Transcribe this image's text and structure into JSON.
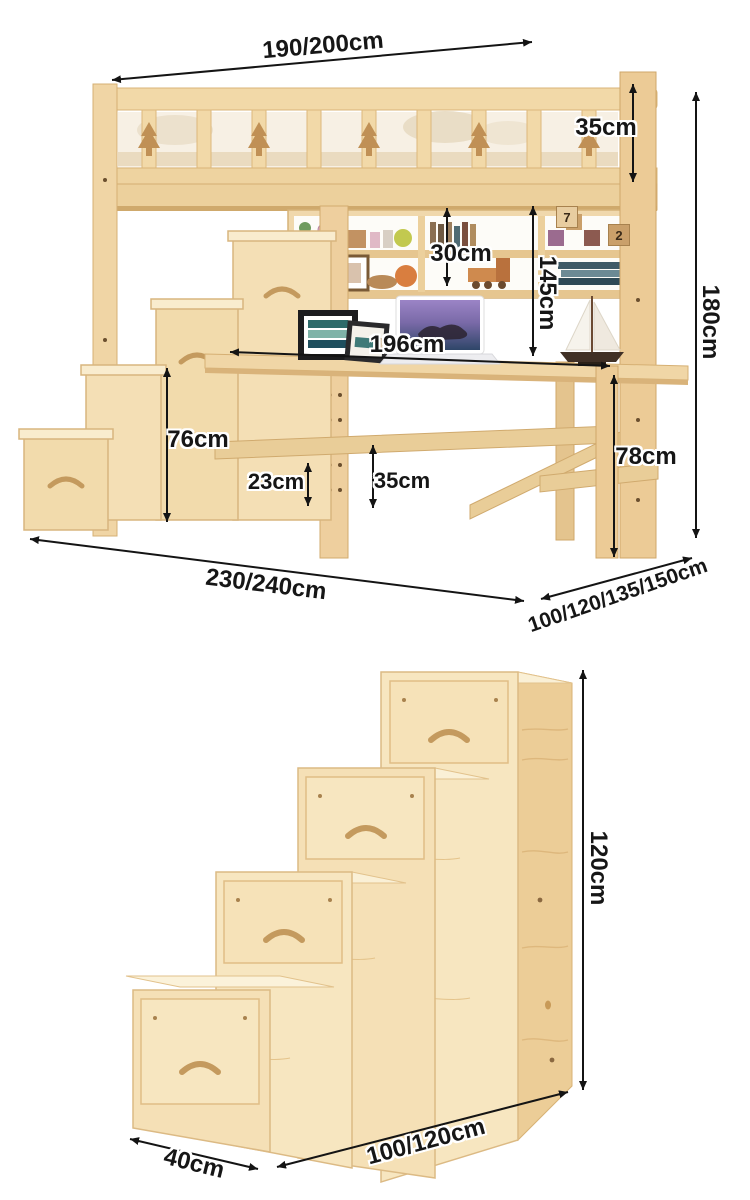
{
  "palette": {
    "wood_light": "#f6e2ba",
    "wood_mid": "#eccd97",
    "wood_deep": "#d9b37a",
    "dimension_line": "#141414"
  },
  "top_diagram": {
    "dimensions": {
      "bed_width": "190/200cm",
      "guardrail_height": "35cm",
      "hutch_shelf_height": "30cm",
      "bed_underside_height": "145cm",
      "overall_height": "180cm",
      "desk_length": "196cm",
      "stair_side_height": "76cm",
      "lower_rail_gap": "23cm",
      "stretcher_height": "35cm",
      "desk_height": "78cm",
      "overall_length": "230/240cm",
      "width_options": "100/120/135/150cm"
    },
    "toy_block_numbers": [
      "7",
      "2"
    ]
  },
  "bottom_diagram": {
    "dimensions": {
      "overall_height": "120cm",
      "length_options": "100/120cm",
      "depth": "40cm"
    }
  }
}
